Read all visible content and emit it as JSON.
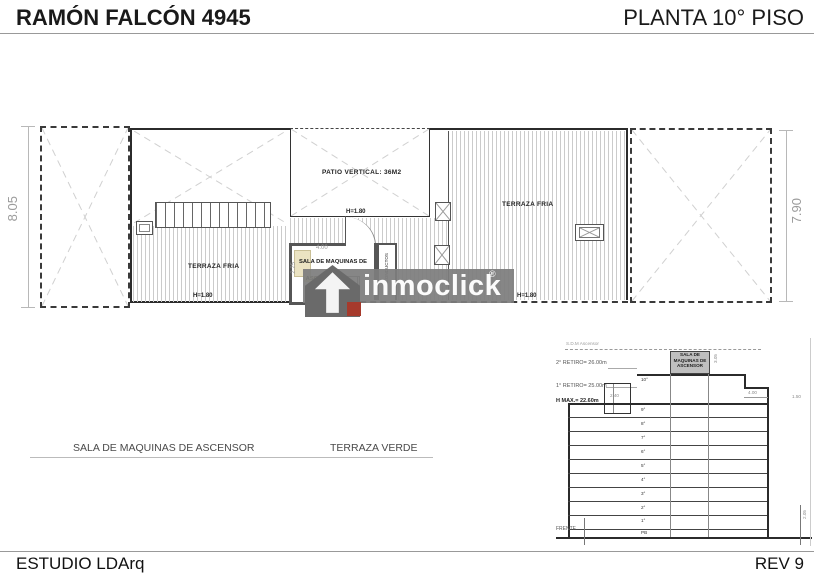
{
  "header": {
    "title": "RAMÓN FALCÓN 4945",
    "plan_label": "PLANTA 10° PISO"
  },
  "plan": {
    "dim_left": "8.05",
    "dim_right": "7.90",
    "patio": {
      "label": "PATIO VERTICAL: 36M2",
      "height_note": "H=1.80"
    },
    "terraza_left": {
      "label": "TERRAZA FRIA",
      "height_note": "H=1.80"
    },
    "terraza_right": {
      "label": "TERRAZA FRIA",
      "height_note": "H=1.80"
    },
    "machine_room": {
      "label_line1": "SALA DE MAQUINAS DE",
      "label_line2": "ASCENSOR",
      "dim_width": "4.00",
      "dim_height": "2.25"
    },
    "shaft_label": "CONDUCTOS"
  },
  "legend": {
    "machine_room": "SALA DE MAQUINAS DE ASCENSOR",
    "green_terrace": "TERRAZA VERDE"
  },
  "watermark": {
    "brand": "inmoclick",
    "registered_mark": "®"
  },
  "section": {
    "sdm_level_label": "S.D.M Ascensor",
    "retiro2_label": "2° RETIRO= 26.00m",
    "retiro1_label": "1° RETIRO= 25.00m",
    "hmax_label": "H MAX.= 22.60m",
    "machine_box": {
      "line1": "SALA DE",
      "line2": "MAQUINAS DE",
      "line3": "ASCENSOR"
    },
    "frente_label": "FRENTE",
    "floors": [
      "10°",
      "9°",
      "8°",
      "7°",
      "6°",
      "5°",
      "4°",
      "3°",
      "2°",
      "1°",
      "PB"
    ],
    "dims": {
      "box_height": "3.05",
      "bulkhead": "2.40",
      "step": "4.00",
      "parapet": "1.50",
      "ground": "2.05"
    }
  },
  "footer": {
    "studio": "ESTUDIO LDArq",
    "revision": "REV 9"
  },
  "colors": {
    "line": "#2b2b2b",
    "hatch": "#cbcbcb",
    "cross": "#d0d0d0",
    "dim_text": "#9b9b9b",
    "watermark_band": "#7d7d7d",
    "brand_red": "#a63a2c",
    "label_highlight": "#f1e6a8"
  }
}
